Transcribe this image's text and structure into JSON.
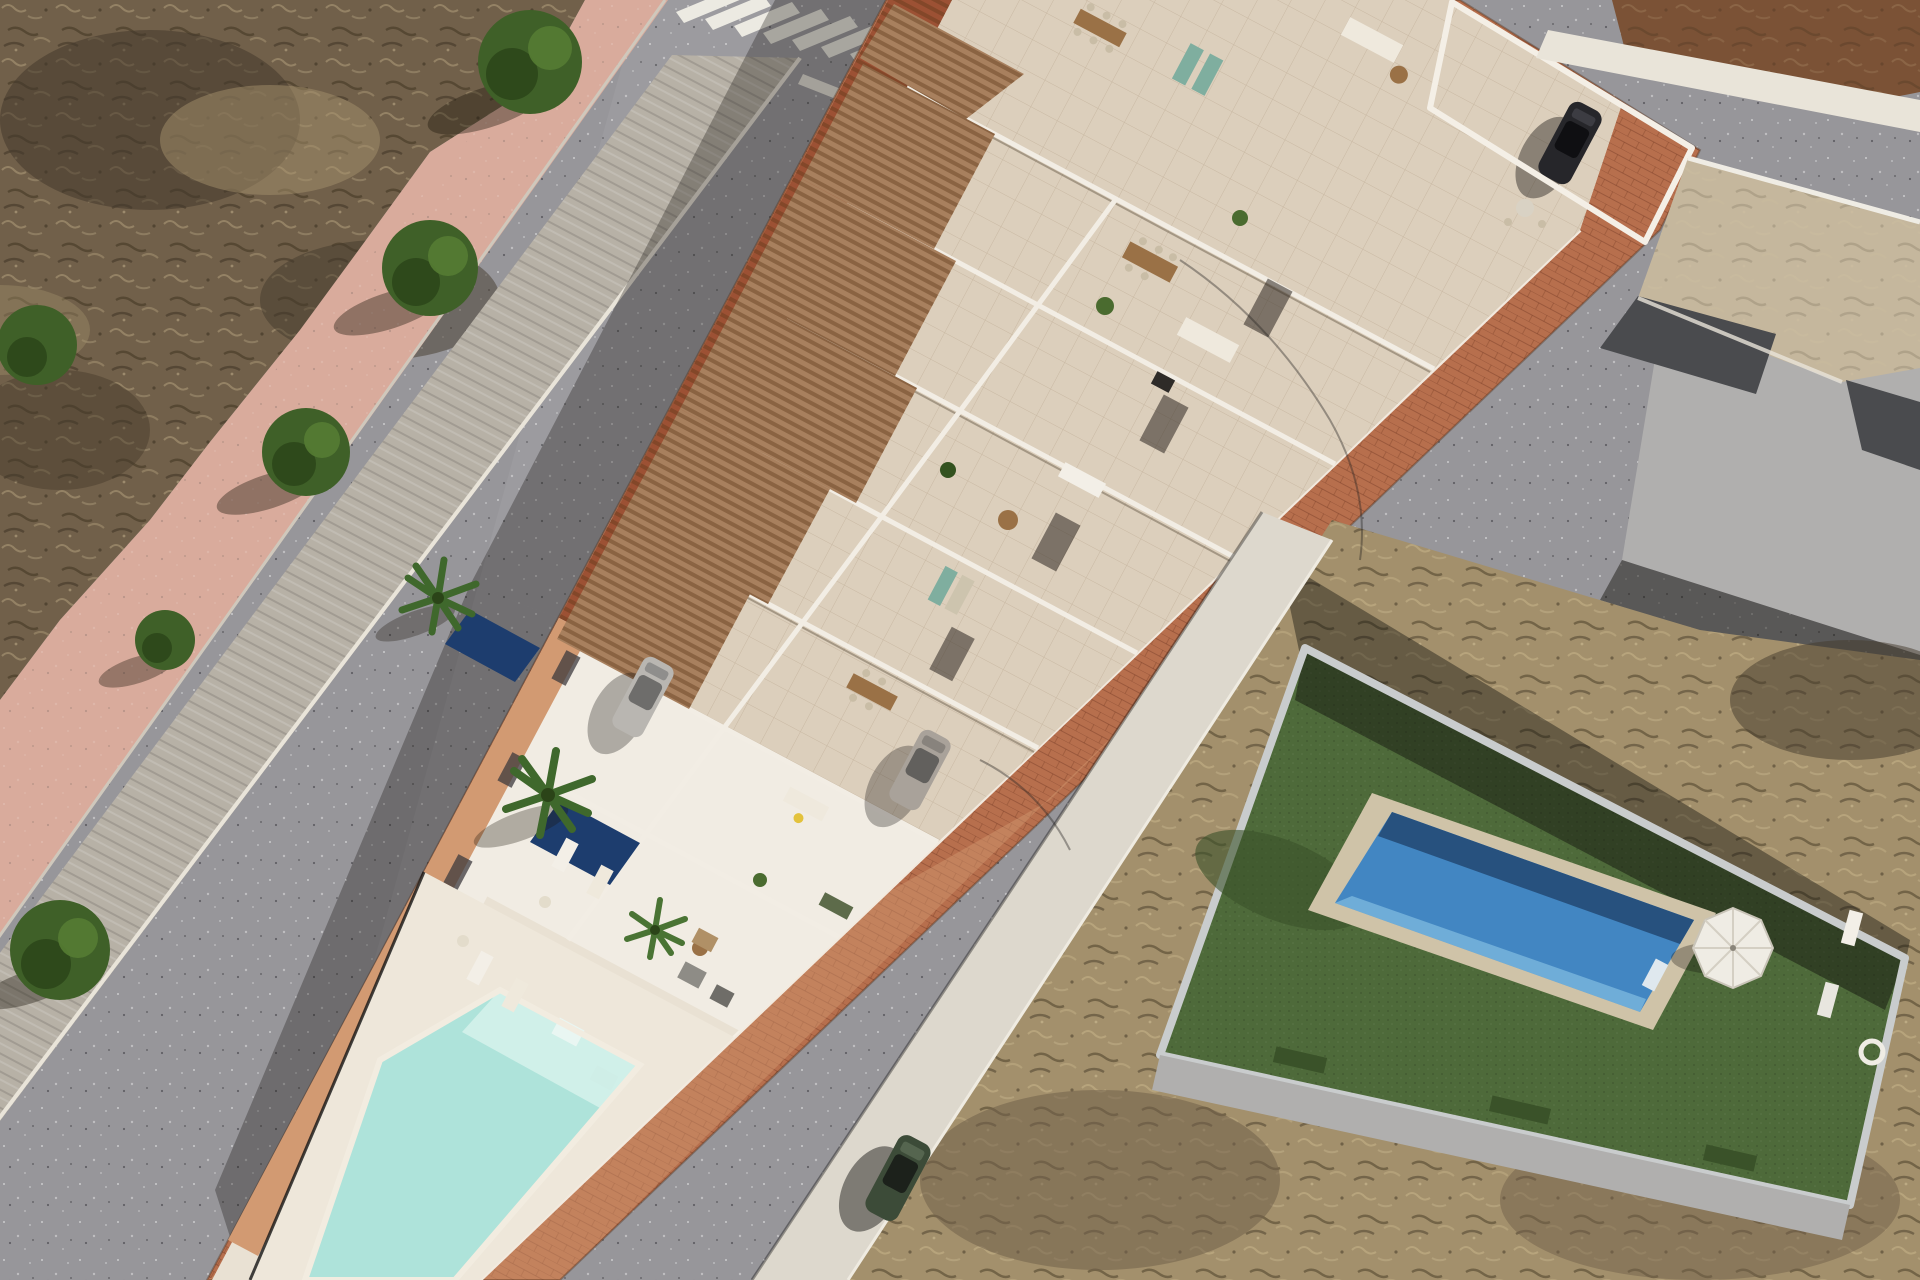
{
  "scene": {
    "title": "Aerial 3D architectural render - coastal townhouse development",
    "type": "architectural-visualization",
    "view": "aerial-oblique",
    "time_of_day": "midday-sun"
  },
  "palette": {
    "asphalt": "#97969a",
    "asphalt_shadow": "rgba(24,21,18,0.32)",
    "sidewalk_pink": "#d9ab9c",
    "stone_walk": "#b7b1a6",
    "curb_white": "#e9e4d9",
    "terracotta": "#b76f4d",
    "terracotta_light": "#d29a72",
    "deck": "#e9e1d3",
    "wall_white": "#f1ece3",
    "wall_shadow": "#cfc7ba",
    "tile": "#dccfbc",
    "pergola_wood": "#a8805e",
    "roof_tile": "#9c5134",
    "pool_turquoise": "#aee3da",
    "pool_turquoise_light": "#d8f2ec",
    "plunge_navy": "#1d3d6e",
    "villa_pool": "#4286c2",
    "villa_pool_dark": "#27517e",
    "turf": "#4e6a3a",
    "turf_dark": "#3a5229",
    "scrub": "#71604a",
    "scrub_dark": "#44392b",
    "scrub_light": "#a3906c",
    "building_gray": "#b0afae",
    "roof_tan": "#c5b79d",
    "roof_charcoal": "#4a4b4e",
    "roof_brown": "#7b5236",
    "tree_green": "#3f6028",
    "tree_green_dark": "#2b4418",
    "car_silver": "#b9b6b1",
    "car_black": "#26262a",
    "car_green": "#3c4b38",
    "umbrella": "#efece4",
    "lounger_white": "#f3efe7",
    "accent_teal": "#7fae9f",
    "accent_yellow": "#e3c23c",
    "sofa_white": "#efe9dd",
    "wood_table": "#9a7146"
  },
  "objects": {
    "development": {
      "label": "new-build white townhouse block",
      "rows_of_units": 7,
      "features": [
        "roof terraces",
        "wood pergolas",
        "outdoor furniture",
        "driveways",
        "private plunge pools",
        "communal pool",
        "terracotta paved sidewalk"
      ]
    },
    "communal_pool": {
      "label": "communal turquoise pool",
      "loungers": 4
    },
    "plunge_pools": 2,
    "villa": {
      "label": "neighboring villa",
      "pool": "blue rectangular pool",
      "umbrella": true,
      "loungers": 2,
      "ground": "artificial turf"
    },
    "vehicles": [
      {
        "label": "silver car in driveway"
      },
      {
        "label": "silver car in driveway"
      },
      {
        "label": "black car in corner carport"
      },
      {
        "label": "dark green car parked on street"
      }
    ],
    "trees_along_sidewalk": 5,
    "palm_trees": 3,
    "crosswalk_stripes": 8,
    "roads": [
      "left street with zebra crossing",
      "right street with lane dashes"
    ],
    "terrain": [
      "dry scrubland top-left",
      "dry scrubland bottom-right"
    ]
  }
}
